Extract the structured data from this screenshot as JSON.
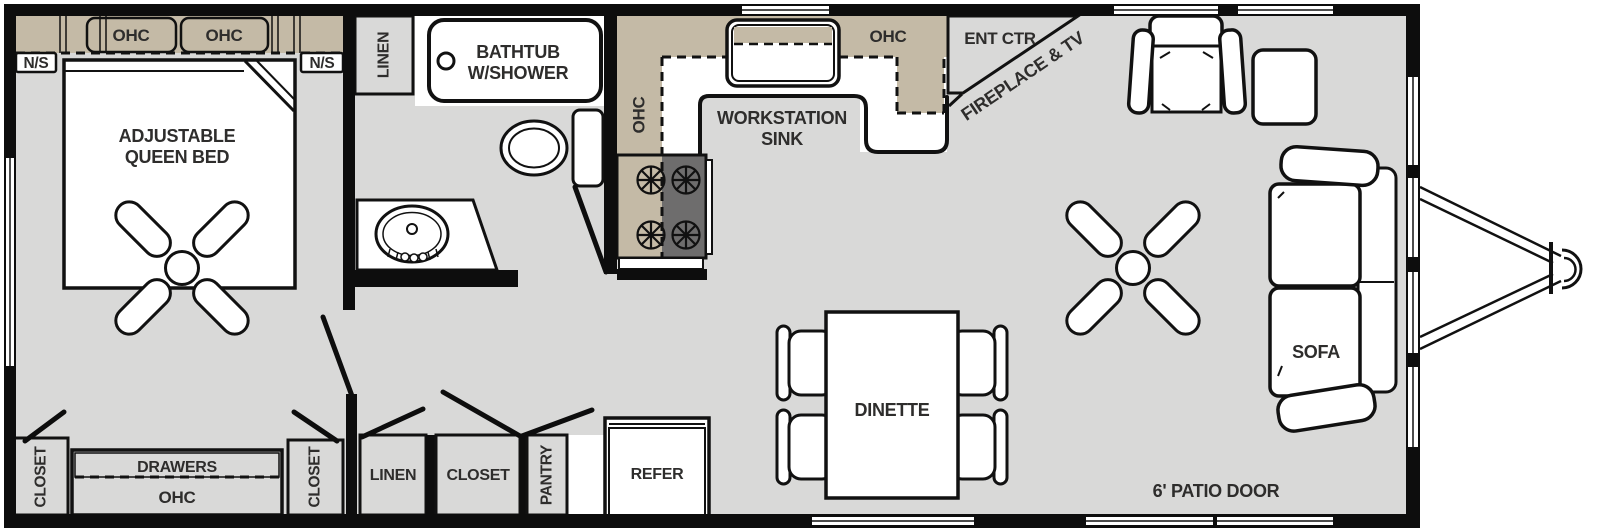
{
  "title": "Travel trailer floor plan",
  "colors": {
    "wall": "#0d0d0d",
    "cabinet_tan": "#c4baa6",
    "floor_gray": "#d9d9d8",
    "appliance_gray": "#6e6d6d",
    "label_text": "#2e2d2c",
    "background": "#ffffff"
  },
  "labels": {
    "bedroom": {
      "ohc_cabinet_left": "OHC",
      "ohc_cabinet_right": "OHC",
      "nightstand_left": "N/S",
      "nightstand_right": "N/S",
      "bed": [
        "ADJUSTABLE",
        "QUEEN BED"
      ],
      "closet_left": "CLOSET",
      "drawers": "DRAWERS",
      "ohc_under_drawers": "OHC",
      "closet_right": "CLOSET"
    },
    "bathroom": {
      "linen": "LINEN",
      "bathtub": [
        "BATHTUB",
        "W/SHOWER"
      ]
    },
    "hallway": {
      "linen": "LINEN",
      "closet": "CLOSET",
      "pantry": "PANTRY",
      "refrigerator": "REFER"
    },
    "kitchen": {
      "ohc_side": "OHC",
      "sink": [
        "WORKSTATION",
        "SINK"
      ],
      "ohc_top": "OHC",
      "entertainment_center": "ENT CTR",
      "fireplace_tv": "FIREPLACE & TV"
    },
    "living_area": {
      "dinette": "DINETTE",
      "sofa": "SOFA",
      "patio_door": "6' PATIO DOOR"
    }
  }
}
